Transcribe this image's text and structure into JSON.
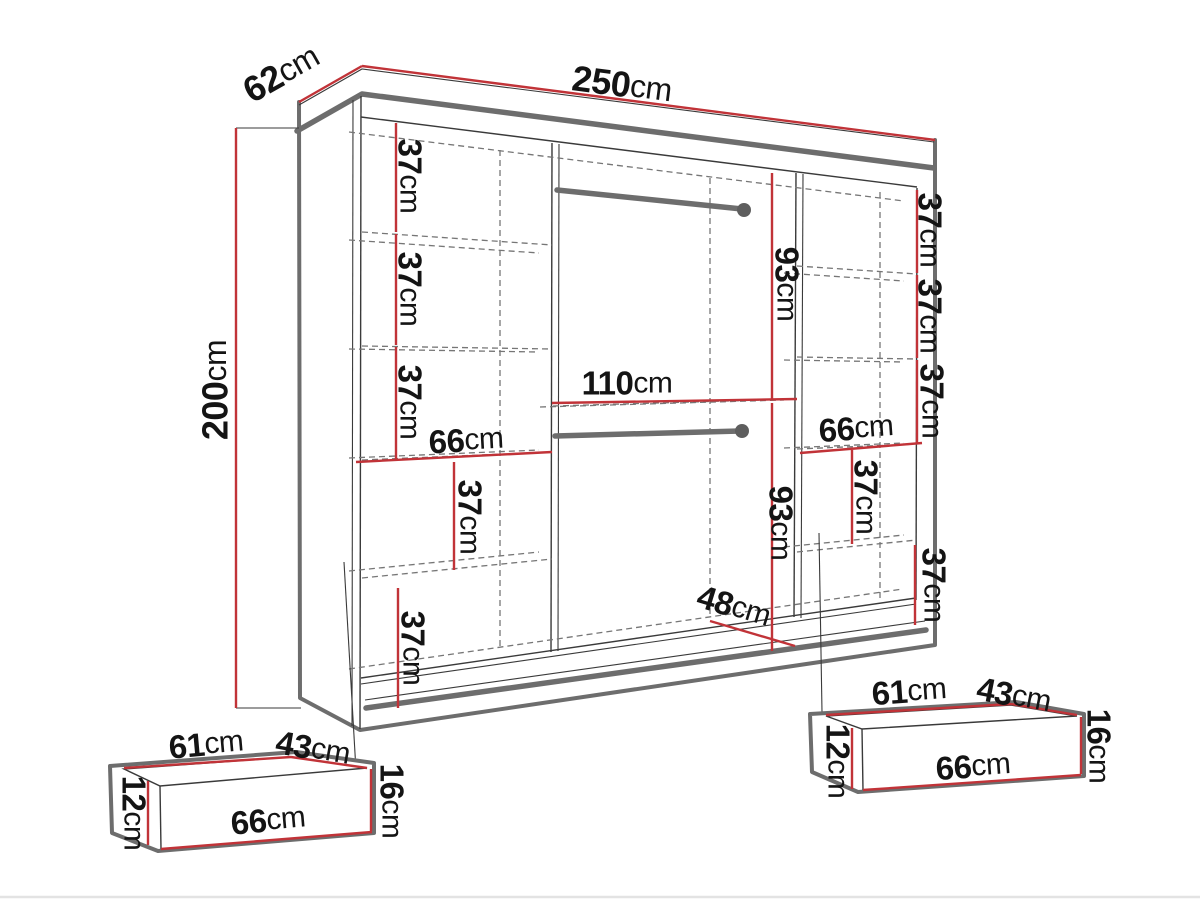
{
  "figure": {
    "kind": "furniture-dimension-diagram",
    "subject": "sliding-door wardrobe with interior shelves, two hanging rails and two under-drawers",
    "background": "white"
  },
  "colors": {
    "dim-red": "#c13338",
    "structure-gray": "#6d6d6d",
    "line-dark": "#3a3a3a",
    "dash-gray": "#767676",
    "text-dark": "#141414",
    "page-bg": "#ffffff",
    "page-edge": "#e3e3e3"
  },
  "values": {
    "unit": "cm",
    "width_250": "250",
    "depth_62": "62",
    "height_200": "200",
    "shelf_37": "37",
    "col_width_66": "66",
    "rail_drop_93": "93",
    "middle_width_110": "110",
    "base_width_48": "48",
    "drawer_inner_width_61": "61",
    "drawer_inner_depth_43": "43",
    "drawer_front_width_66": "66",
    "drawer_front_height_16": "16",
    "drawer_side_height_12": "12"
  },
  "dimensions": {
    "overall": {
      "width_cm": 250,
      "depth_cm": 62,
      "height_cm": 200
    },
    "left_column": {
      "width_cm": 66,
      "shelf_spacing_cm": [
        37,
        37,
        37,
        37,
        37
      ]
    },
    "middle_section": {
      "width_cm": 110,
      "upper_rail_drop_cm": 93,
      "lower_rail_drop_cm": 93,
      "base_width_cm": 48,
      "hanging_rails": 2
    },
    "right_column": {
      "width_cm": 66,
      "shelf_spacing_cm": [
        37,
        37,
        37,
        37,
        37
      ]
    },
    "drawers": [
      {
        "inner_width_cm": 61,
        "inner_depth_cm": 43,
        "front_width_cm": 66,
        "front_height_cm": 16,
        "side_height_cm": 12
      },
      {
        "inner_width_cm": 61,
        "inner_depth_cm": 43,
        "front_width_cm": 66,
        "front_height_cm": 16,
        "side_height_cm": 12
      }
    ]
  }
}
